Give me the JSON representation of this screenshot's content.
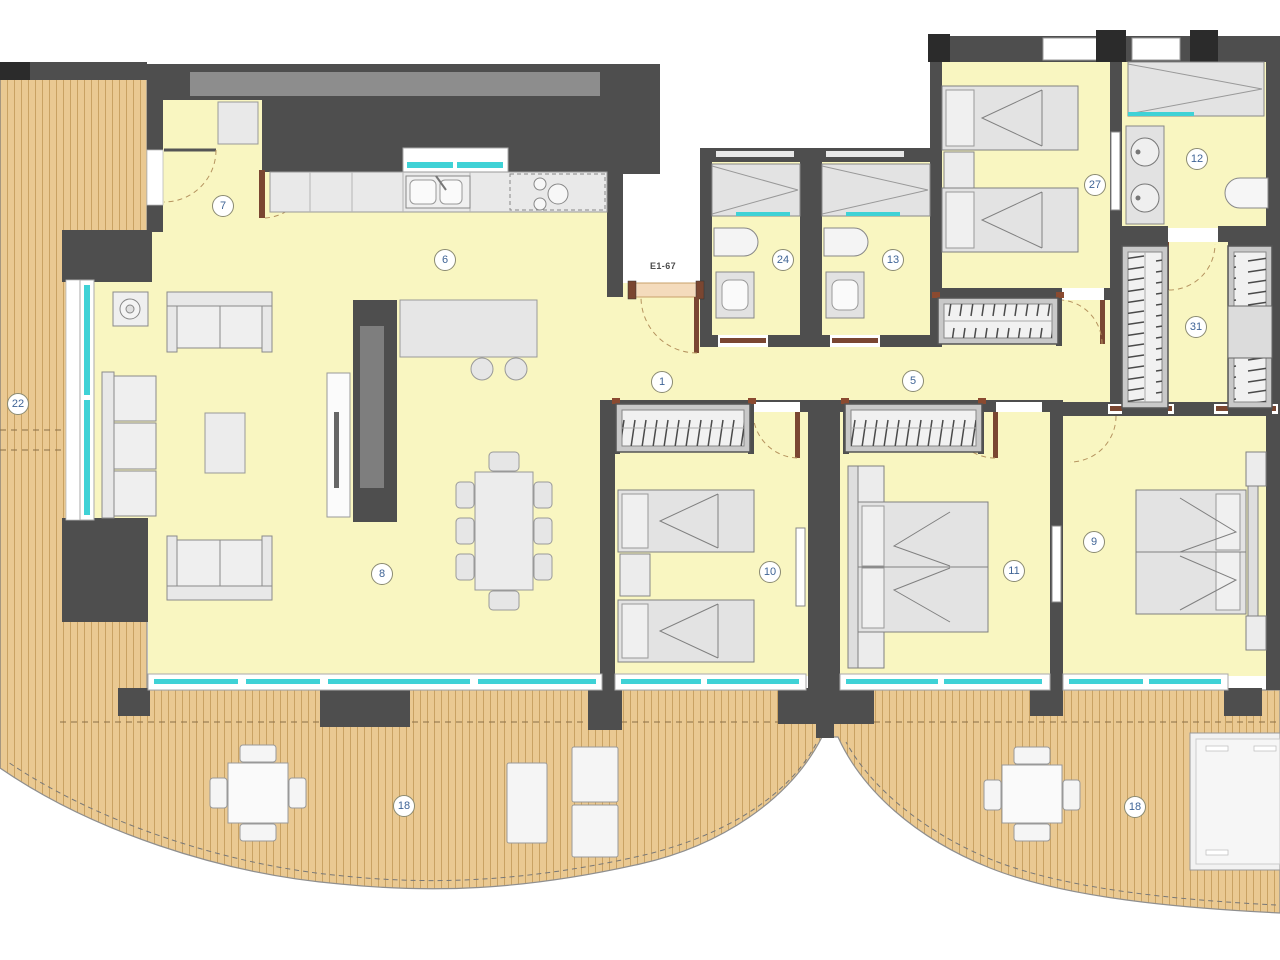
{
  "entrance": {
    "door_code": "E1-67"
  },
  "rooms": [
    {
      "number": "7"
    },
    {
      "number": "6"
    },
    {
      "number": "1"
    },
    {
      "number": "24"
    },
    {
      "number": "13"
    },
    {
      "number": "27"
    },
    {
      "number": "12"
    },
    {
      "number": "31"
    },
    {
      "number": "5"
    },
    {
      "number": "8"
    },
    {
      "number": "10"
    },
    {
      "number": "11"
    },
    {
      "number": "9"
    },
    {
      "number": "22"
    },
    {
      "number": "18"
    },
    {
      "number": "18"
    }
  ],
  "colors": {
    "wall": "#4e4e4e",
    "wall_inset": "#8d8d8d",
    "floor": "#f9f6c1",
    "deck": "#eac992",
    "deck_line": "#c9a263",
    "glazing": "#3fd2d6",
    "door": "#7a4631",
    "door_mat": "#f4dbbc",
    "label_text": "#3f6496",
    "label_border": "#8a8a72"
  }
}
